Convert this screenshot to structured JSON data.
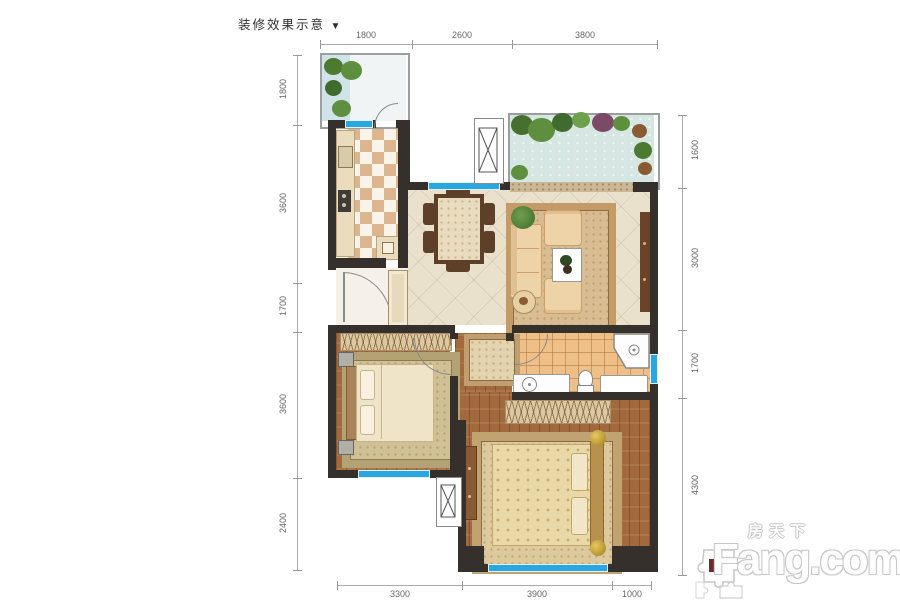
{
  "header": {
    "title": "装修效果示意",
    "arrow": "▼"
  },
  "dims": {
    "top": [
      "1800",
      "2600",
      "3800"
    ],
    "left": [
      "1800",
      "3600",
      "1700",
      "3600",
      "2400"
    ],
    "right": [
      "1600",
      "3000",
      "1700",
      "4300"
    ],
    "bottom": [
      "3300",
      "3900",
      "1000"
    ]
  },
  "watermark": {
    "cn": "房天下",
    "en": "Fang.com"
  },
  "colors": {
    "wall": "#35302b",
    "window": "#2ba7e0",
    "wood_floor": "#a26a3c",
    "marble_floor": "#eae1cd",
    "bath_tile": "#eec088",
    "garden": "#d6e7e3",
    "rug": "#d9bd92",
    "plant_green": "#5d8f3f",
    "plant_purple": "#7b4a67"
  }
}
